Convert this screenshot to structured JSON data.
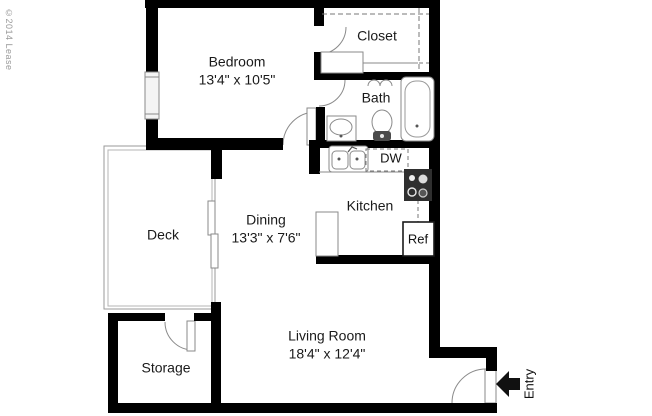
{
  "copyright": "©2014 Lease",
  "rooms": {
    "bedroom": {
      "name": "Bedroom",
      "dimensions": "13'4\" x 10'5\""
    },
    "closet": {
      "name": "Closet"
    },
    "bath": {
      "name": "Bath"
    },
    "kitchen": {
      "name": "Kitchen"
    },
    "dining": {
      "name": "Dining",
      "dimensions": "13'3\" x 7'6\""
    },
    "deck": {
      "name": "Deck"
    },
    "storage": {
      "name": "Storage"
    },
    "living_room": {
      "name": "Living Room",
      "dimensions": "18'4\" x 12'4\""
    }
  },
  "appliances": {
    "dishwasher_label": "DW",
    "refrigerator_label": "Ref"
  },
  "entry": {
    "label": "Entry"
  },
  "colors": {
    "wall": "#000000",
    "fixture_line": "#8a8a8a",
    "dashed_line": "#777777",
    "text": "#1a1a1a",
    "copyright_text": "#9a9a9a",
    "stove_fill": "#2f2f2f",
    "background": "#ffffff"
  }
}
